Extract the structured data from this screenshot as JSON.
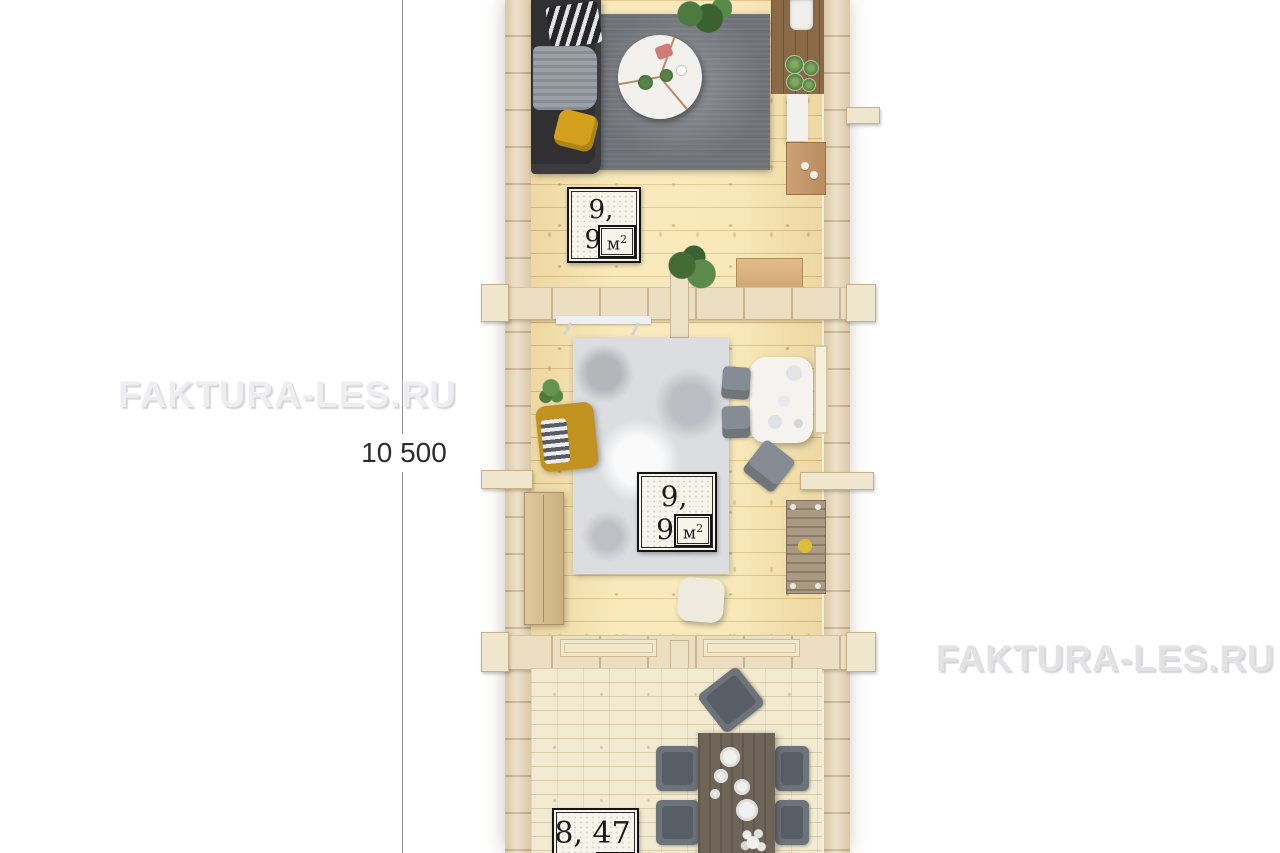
{
  "watermark": {
    "left_text": "FAKTURA-LES.RU",
    "right_text": "FAKTURA-LES.RU"
  },
  "dimension": {
    "length_label": "10 500"
  },
  "plan": {
    "rooms": [
      {
        "name": "living-room",
        "area_value": "9, 90",
        "area_unit": "м",
        "area_exponent": "2"
      },
      {
        "name": "bedroom",
        "area_value": "9, 90",
        "area_unit": "м",
        "area_exponent": "2"
      },
      {
        "name": "dining-room",
        "area_value": "8, 47",
        "area_unit": "м",
        "area_exponent": "2"
      }
    ]
  },
  "colors": {
    "background": "#ffffff",
    "wall_wood": "#e8d8b8",
    "floor_wood": "#f7e4b0",
    "floor_dining": "#f3ebd1",
    "dimension_line": "#8f8f8f",
    "watermark_gray": "#e6e6e9",
    "label_border": "#141414"
  }
}
